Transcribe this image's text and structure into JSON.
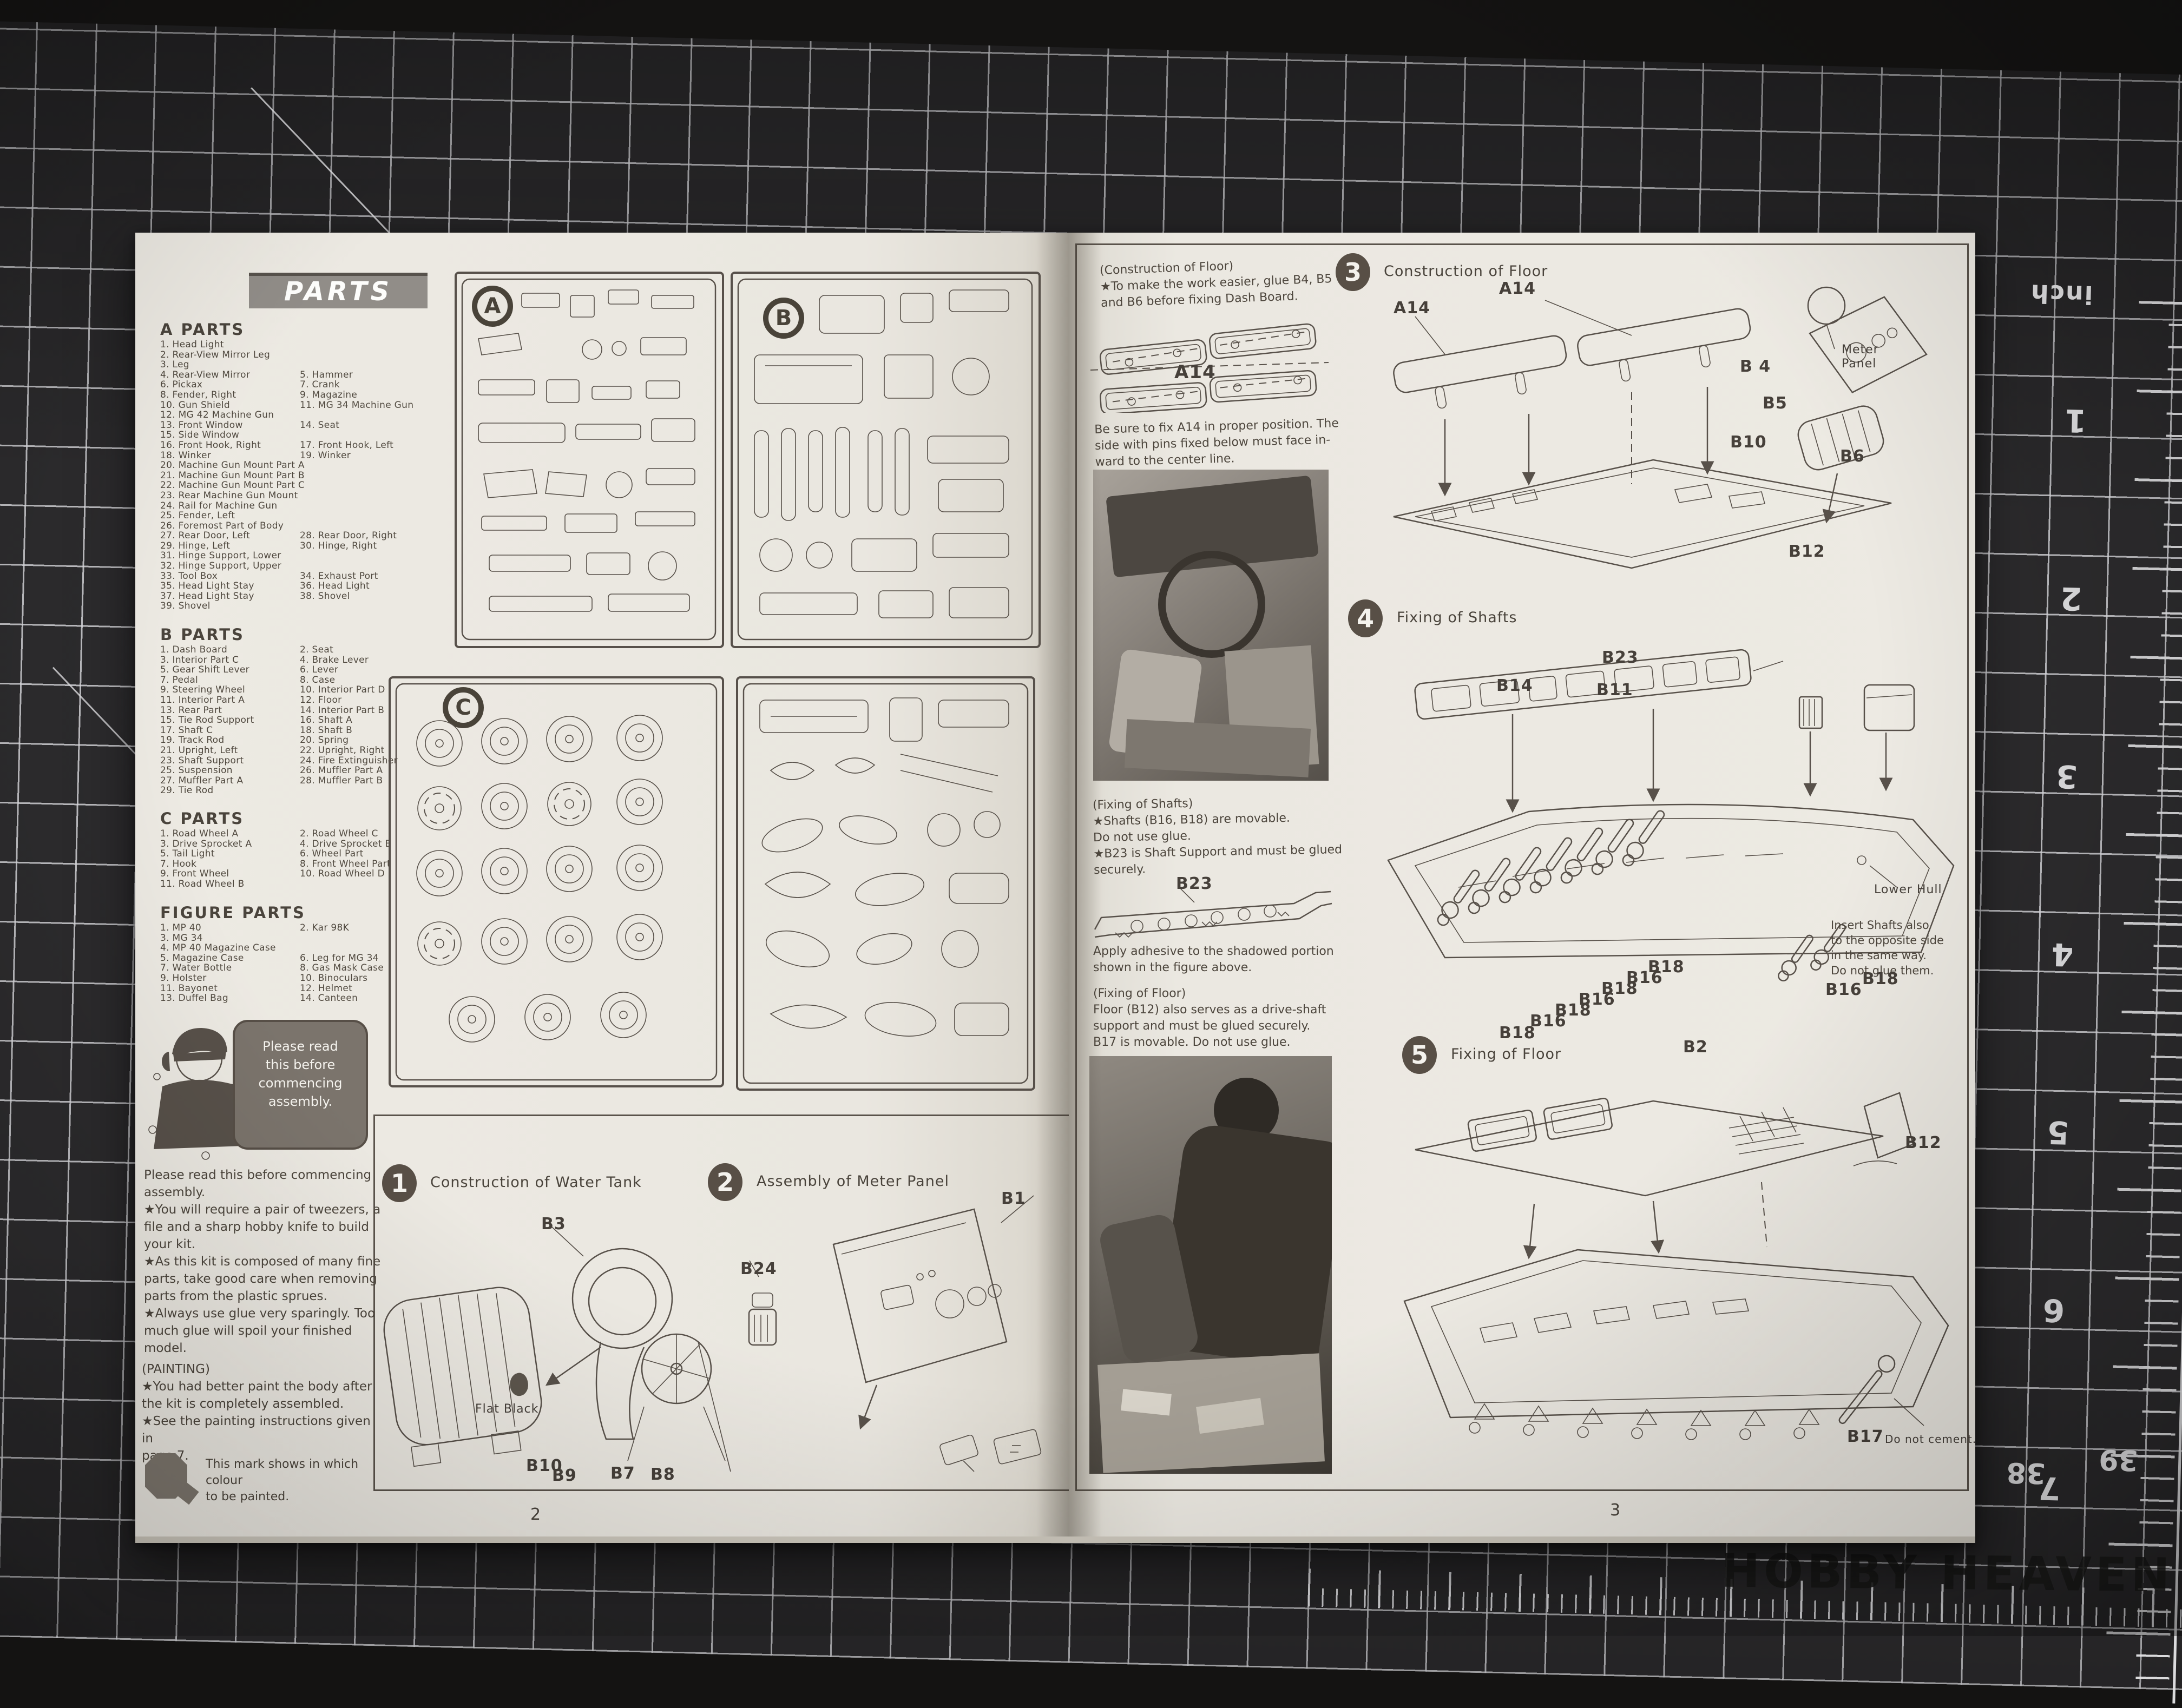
{
  "watermark": "HOBBY HEAVEN",
  "mat": {
    "unit_label": "inch",
    "ruler_numbers": [
      "1",
      "2",
      "3",
      "4",
      "5",
      "6",
      "7"
    ],
    "edge_numbers": [
      "38",
      "39"
    ]
  },
  "left_page": {
    "page_number": "2",
    "parts_banner": "PARTS",
    "sprue_letters": [
      "A",
      "B",
      "C"
    ],
    "sections": [
      {
        "title": "A PARTS",
        "rows": [
          [
            "1. Head Light",
            ""
          ],
          [
            "2. Rear-View Mirror Leg",
            ""
          ],
          [
            "3. Leg",
            ""
          ],
          [
            "4. Rear-View Mirror",
            "5. Hammer"
          ],
          [
            "6. Pickax",
            "7. Crank"
          ],
          [
            "8. Fender, Right",
            "9. Magazine"
          ],
          [
            "10. Gun Shield",
            "11. MG 34 Machine Gun"
          ],
          [
            "12. MG 42 Machine Gun",
            ""
          ],
          [
            "13. Front Window",
            "14. Seat"
          ],
          [
            "15. Side Window",
            ""
          ],
          [
            "16. Front Hook, Right",
            "17. Front Hook, Left"
          ],
          [
            "18. Winker",
            "19. Winker"
          ],
          [
            "20. Machine Gun Mount Part A",
            ""
          ],
          [
            "21. Machine Gun Mount Part B",
            ""
          ],
          [
            "22. Machine Gun Mount Part C",
            ""
          ],
          [
            "23. Rear Machine Gun Mount",
            ""
          ],
          [
            "24. Rail for Machine Gun",
            ""
          ],
          [
            "25. Fender, Left",
            ""
          ],
          [
            "26. Foremost Part of Body",
            ""
          ],
          [
            "27. Rear Door, Left",
            "28. Rear Door, Right"
          ],
          [
            "29. Hinge, Left",
            "30. Hinge, Right"
          ],
          [
            "31. Hinge Support, Lower",
            ""
          ],
          [
            "32. Hinge Support, Upper",
            ""
          ],
          [
            "33. Tool Box",
            "34. Exhaust Port"
          ],
          [
            "35. Head Light Stay",
            "36. Head Light"
          ],
          [
            "37. Head Light Stay",
            "38. Shovel"
          ],
          [
            "39. Shovel",
            ""
          ]
        ]
      },
      {
        "title": "B PARTS",
        "rows": [
          [
            "1. Dash Board",
            "2. Seat"
          ],
          [
            "3. Interior Part C",
            "4. Brake Lever"
          ],
          [
            "5. Gear Shift Lever",
            "6. Lever"
          ],
          [
            "7. Pedal",
            "8. Case"
          ],
          [
            "9. Steering Wheel",
            "10. Interior Part D"
          ],
          [
            "11. Interior Part A",
            "12. Floor"
          ],
          [
            "13. Rear Part",
            "14. Interior Part B"
          ],
          [
            "15. Tie Rod Support",
            "16. Shaft A"
          ],
          [
            "17. Shaft C",
            "18. Shaft B"
          ],
          [
            "19. Track Rod",
            "20. Spring"
          ],
          [
            "21. Upright, Left",
            "22. Upright, Right"
          ],
          [
            "23. Shaft Support",
            "24. Fire Extinguisher"
          ],
          [
            "25. Suspension",
            "26. Muffler Part A"
          ],
          [
            "27. Muffler Part A",
            "28. Muffler Part B"
          ],
          [
            "29. Tie Rod",
            ""
          ]
        ]
      },
      {
        "title": "C PARTS",
        "rows": [
          [
            "1. Road Wheel A",
            "2. Road Wheel C"
          ],
          [
            "3. Drive Sprocket A",
            "4. Drive Sprocket B"
          ],
          [
            "5. Tail Light",
            "6. Wheel Part"
          ],
          [
            "7. Hook",
            "8. Front Wheel Part"
          ],
          [
            "9. Front Wheel",
            "10. Road Wheel D"
          ],
          [
            "11. Road Wheel B",
            ""
          ]
        ]
      },
      {
        "title": "FIGURE PARTS",
        "rows": [
          [
            "1. MP 40",
            "2. Kar 98K"
          ],
          [
            "3. MG 34",
            ""
          ],
          [
            "4. MP 40 Magazine Case",
            ""
          ],
          [
            "5. Magazine Case",
            "6. Leg for MG 34"
          ],
          [
            "7. Water Bottle",
            "8. Gas Mask Case"
          ],
          [
            "9. Holster",
            "10. Binoculars"
          ],
          [
            "11. Bayonet",
            "12. Helmet"
          ],
          [
            "13. Duffel Bag",
            "14. Canteen"
          ]
        ]
      }
    ],
    "bubble_lines": [
      "Please read",
      "this before",
      "commencing",
      "assembly."
    ],
    "intro_lines": [
      "Please read this before commencing",
      "assembly.",
      "★You will require  a pair of tweezers, a",
      "file and a sharp hobby knife to build",
      "your kit.",
      "★As this kit is composed of many fine",
      "parts, take good care when removing",
      "parts from the plastic sprues.",
      "★Always use glue very sparingly.  Too",
      "much glue will spoil your finished model."
    ],
    "painting_lines": [
      "(PAINTING)",
      "★You had better paint the body after",
      "the kit is completely assembled.",
      "★See the painting instructions given in",
      "page 7."
    ],
    "mark_note_lines": [
      "This mark shows in which colour",
      "to be painted."
    ],
    "steps": [
      {
        "num": "1",
        "title": "Construction of Water Tank"
      },
      {
        "num": "2",
        "title": "Assembly of Meter Panel"
      }
    ],
    "labels": {
      "b3": "B3",
      "b24": "B24",
      "b1": "B1",
      "b10": "B10",
      "b9": "B9",
      "b7": "B7",
      "b8": "B8",
      "flat_black": "Flat Black"
    }
  },
  "right_page": {
    "page_number": "3",
    "note_floor_lines": [
      "(Construction of Floor)",
      "★To make the work easier, glue B4, B5",
      "and B6 before fixing Dash Board."
    ],
    "a14_caption": "A14",
    "note_a14_lines": [
      "Be sure to fix A14 in proper position. The",
      "side with pins fixed below must face in-",
      "ward to the center line."
    ],
    "note_shafts_lines": [
      "(Fixing of Shafts)",
      "★Shafts (B16, B18) are movable.",
      "  Do not use glue.",
      "★B23 is Shaft Support and must be glued",
      "securely."
    ],
    "b23_caption": "B23",
    "note_adhesive_lines": [
      "Apply adhesive to the shadowed portion",
      "shown in the figure above."
    ],
    "note_floor2_lines": [
      "(Fixing of Floor)",
      "Floor (B12) also serves as a drive-shaft",
      "support and must be glued securely.",
      "B17 is movable.  Do not use glue."
    ],
    "steps": [
      {
        "num": "3",
        "title": "Construction of Floor"
      },
      {
        "num": "4",
        "title": "Fixing of Shafts"
      },
      {
        "num": "5",
        "title": "Fixing of Floor"
      }
    ],
    "step3_labels": {
      "a14_left": "A14",
      "a14_right": "A14",
      "meter_panel": "Meter Panel",
      "b4": "B 4",
      "b5": "B5",
      "b10": "B10",
      "b6": "B6",
      "b12": "B12"
    },
    "step4_labels": {
      "b23": "B23",
      "b14": "B14",
      "b11": "B11",
      "lower_hull": "Lower Hull",
      "insert_note_lines": [
        "Insert Shafts also",
        "to the opposite side",
        "in the same way.",
        "Do not glue them."
      ],
      "shaft_labels": [
        "B18",
        "B16",
        "B18",
        "B16",
        "B18",
        "B16",
        "B18",
        "B16",
        "B18"
      ]
    },
    "step5_labels": {
      "b2": "B2",
      "b12": "B12",
      "b17": "B17",
      "b17_note": "Do not cement."
    }
  }
}
